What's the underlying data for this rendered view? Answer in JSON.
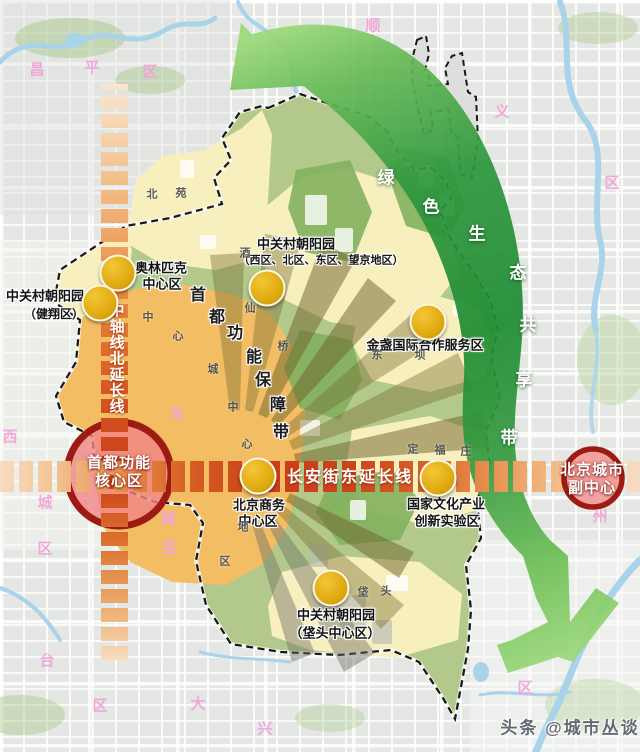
{
  "colors": {
    "axis_dark": "#c93e1a",
    "axis_light": "#f7dcc0",
    "belt_dark": "#1f8c33",
    "belt_light": "#9bd97a",
    "anchor_ring": "#9d1b12",
    "anchor_fill": "#f08484",
    "node_yellow": "#dfa90f",
    "cream_zone": "#f7efbe",
    "district_green": "#b2c98b",
    "central_orange": "#f3bd64",
    "region_label_pink": "#f1a4da"
  },
  "axes": {
    "horizontal": {
      "label": "长安街东延长线",
      "x": 350,
      "y": 478,
      "size": 16
    },
    "vertical": {
      "label": "中轴线北延长线",
      "x": 117,
      "y_start": 311,
      "step": 16,
      "size": 15
    }
  },
  "anchors": [
    {
      "n": "label-core-area-line1",
      "t": "首都功能",
      "x": 119,
      "y": 463,
      "s": 15
    },
    {
      "n": "label-core-area-line2",
      "t": "核心区",
      "x": 119,
      "y": 481,
      "s": 15
    },
    {
      "n": "label-sub-center-line1",
      "t": "北京城市",
      "x": 592,
      "y": 470,
      "s": 15
    },
    {
      "n": "label-sub-center-line2",
      "t": "副中心",
      "x": 592,
      "y": 488,
      "s": 15
    }
  ],
  "nodes": [
    {
      "n": "node-olympic-center",
      "x": 118,
      "y": 273
    },
    {
      "n": "node-jianxiang",
      "x": 100,
      "y": 303
    },
    {
      "n": "node-wangjing",
      "x": 267,
      "y": 288
    },
    {
      "n": "node-jinzhan",
      "x": 428,
      "y": 322
    },
    {
      "n": "node-cbd",
      "x": 258,
      "y": 476
    },
    {
      "n": "node-culture-zone",
      "x": 438,
      "y": 478
    },
    {
      "n": "node-fatou",
      "x": 331,
      "y": 588
    }
  ],
  "zone_labels": [
    {
      "n": "label-olympic-line1",
      "t": "奥林匹克",
      "x": 161,
      "y": 268,
      "s": 13
    },
    {
      "n": "label-olympic-line2",
      "t": "中心区",
      "x": 162,
      "y": 284,
      "s": 13
    },
    {
      "n": "label-jianxiang-line1",
      "t": "中关村朝阳园",
      "x": 45,
      "y": 296,
      "s": 13
    },
    {
      "n": "label-jianxiang-line2",
      "t": "（健翔区）",
      "x": 54,
      "y": 314,
      "s": 12
    },
    {
      "n": "label-wangjing-line1",
      "t": "中关村朝阳园",
      "x": 296,
      "y": 244,
      "s": 13
    },
    {
      "n": "label-wangjing-line2",
      "t": "（西区、北区、东区、望京地区）",
      "x": 321,
      "y": 261,
      "s": 11
    },
    {
      "n": "label-jinzhan",
      "t": "金盏国际合作服务区",
      "x": 425,
      "y": 345,
      "s": 13
    },
    {
      "n": "label-cbd-line1",
      "t": "北京商务",
      "x": 259,
      "y": 505,
      "s": 13
    },
    {
      "n": "label-cbd-line2",
      "t": "中心区",
      "x": 258,
      "y": 521,
      "s": 13
    },
    {
      "n": "label-culture-line1",
      "t": "国家文化产业",
      "x": 446,
      "y": 504,
      "s": 13
    },
    {
      "n": "label-culture-line2",
      "t": "创新实验区",
      "x": 447,
      "y": 521,
      "s": 13
    },
    {
      "n": "label-fatou-line1",
      "t": "中关村朝阳园",
      "x": 336,
      "y": 615,
      "s": 13
    },
    {
      "n": "label-fatou-line2",
      "t": "（垡头中心区）",
      "x": 335,
      "y": 633,
      "s": 13
    }
  ],
  "green_belt": {
    "label": "绿色生态共享带",
    "chars": [
      {
        "t": "绿",
        "x": 386,
        "y": 178
      },
      {
        "t": "色",
        "x": 431,
        "y": 207
      },
      {
        "t": "生",
        "x": 477,
        "y": 234
      },
      {
        "t": "态",
        "x": 518,
        "y": 273
      },
      {
        "t": "共",
        "x": 528,
        "y": 325
      },
      {
        "t": "享",
        "x": 524,
        "y": 380
      },
      {
        "t": "带",
        "x": 509,
        "y": 438
      }
    ],
    "size": 17
  },
  "support_band": {
    "label": "首都功能保障带",
    "chars": [
      {
        "t": "首",
        "x": 198,
        "y": 296
      },
      {
        "t": "都",
        "x": 217,
        "y": 318
      },
      {
        "t": "功",
        "x": 235,
        "y": 334
      },
      {
        "t": "能",
        "x": 254,
        "y": 358
      },
      {
        "t": "保",
        "x": 263,
        "y": 381
      },
      {
        "t": "障",
        "x": 278,
        "y": 406
      },
      {
        "t": "带",
        "x": 281,
        "y": 433
      }
    ],
    "size": 16
  },
  "region_chars": [
    {
      "t": "昌",
      "x": 37,
      "y": 70
    },
    {
      "t": "平",
      "x": 92,
      "y": 68
    },
    {
      "t": "区",
      "x": 150,
      "y": 72
    },
    {
      "t": "顺",
      "x": 373,
      "y": 26
    },
    {
      "t": "义",
      "x": 502,
      "y": 112
    },
    {
      "t": "区",
      "x": 612,
      "y": 183
    },
    {
      "t": "西",
      "x": 10,
      "y": 437
    },
    {
      "t": "城",
      "x": 45,
      "y": 503
    },
    {
      "t": "区",
      "x": 45,
      "y": 549
    },
    {
      "t": "东",
      "x": 177,
      "y": 415
    },
    {
      "t": "城",
      "x": 168,
      "y": 519
    },
    {
      "t": "区",
      "x": 170,
      "y": 548
    },
    {
      "t": "台",
      "x": 47,
      "y": 661
    },
    {
      "t": "区",
      "x": 100,
      "y": 706
    },
    {
      "t": "大",
      "x": 198,
      "y": 704
    },
    {
      "t": "兴",
      "x": 265,
      "y": 729
    },
    {
      "t": "州",
      "x": 600,
      "y": 517
    },
    {
      "t": "区",
      "x": 525,
      "y": 688
    }
  ],
  "place_chars": [
    {
      "t": "北",
      "x": 152,
      "y": 195
    },
    {
      "t": "苑",
      "x": 181,
      "y": 194
    },
    {
      "t": "酒",
      "x": 245,
      "y": 254
    },
    {
      "t": "仙",
      "x": 250,
      "y": 309
    },
    {
      "t": "桥",
      "x": 283,
      "y": 347
    },
    {
      "t": "中",
      "x": 148,
      "y": 318
    },
    {
      "t": "心",
      "x": 178,
      "y": 337
    },
    {
      "t": "城",
      "x": 213,
      "y": 370
    },
    {
      "t": "中",
      "x": 233,
      "y": 408
    },
    {
      "t": "心",
      "x": 247,
      "y": 445
    },
    {
      "t": "地",
      "x": 243,
      "y": 528
    },
    {
      "t": "区",
      "x": 225,
      "y": 562
    },
    {
      "t": "东",
      "x": 377,
      "y": 356
    },
    {
      "t": "坝",
      "x": 420,
      "y": 356
    },
    {
      "t": "定",
      "x": 413,
      "y": 450
    },
    {
      "t": "福",
      "x": 440,
      "y": 451
    },
    {
      "t": "庄",
      "x": 466,
      "y": 452
    },
    {
      "t": "垡",
      "x": 363,
      "y": 593
    },
    {
      "t": "头",
      "x": 386,
      "y": 592
    }
  ],
  "watermark": {
    "text": "头条 @城市丛谈",
    "x": 570,
    "y": 728,
    "size": 17
  }
}
